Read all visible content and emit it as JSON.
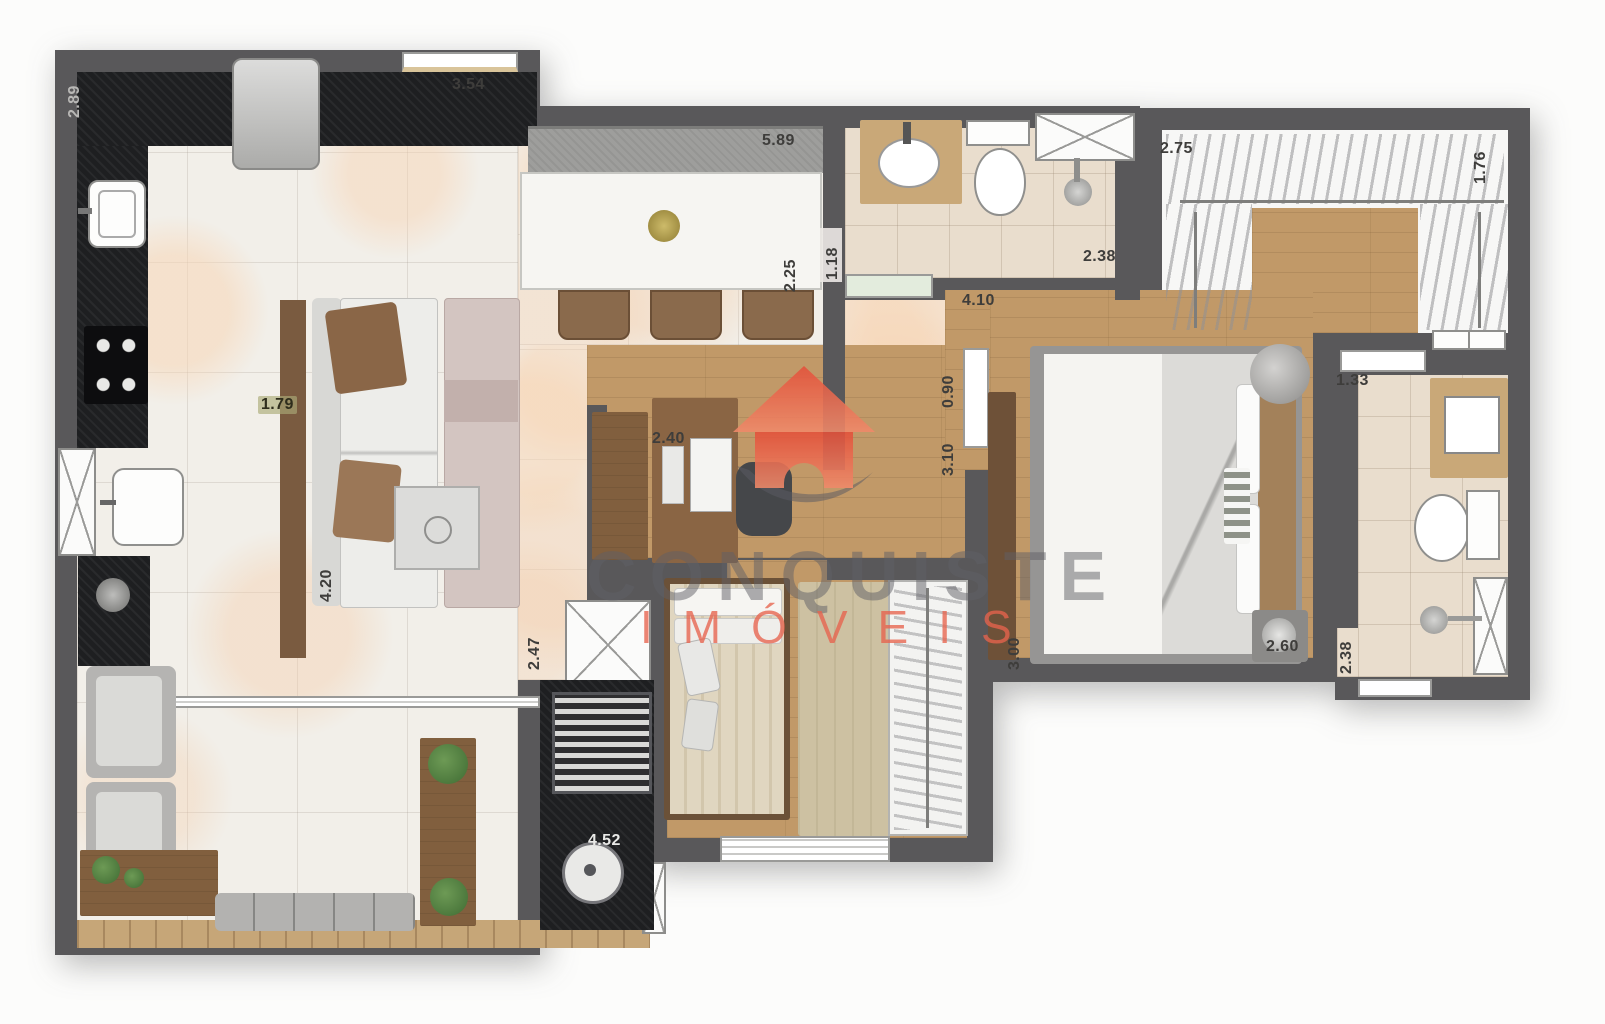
{
  "watermark": {
    "line1": "CONQUISTE",
    "line2": "IMÓVEIS",
    "accent_color": "#E7634D"
  },
  "colors": {
    "wall": "#59585A",
    "marble_floor": "#F2EFE9",
    "wood_floor": "#C19968",
    "bath_tile": "#E9DDCD",
    "counter_black": "#1E1F21",
    "watermark_red": "#E7634D"
  },
  "dimensions": {
    "kitchen_depth": "2.89",
    "kitchen_width": "3.54",
    "living_front": "5.89",
    "dining_depth": "2.25",
    "bath1_entry": "1.18",
    "bath1_width": "2.38",
    "closet_width": "2.75",
    "closet_depth": "1.76",
    "hall_length": "4.10",
    "bedroom_door": "0.90",
    "office_depth": "3.10",
    "kitchen_pass": "1.79",
    "office_width": "2.40",
    "sofa_wall": "4.20",
    "living_depth": "2.47",
    "terrace_width": "4.52",
    "master_width": "3.00",
    "master_foot": "2.60",
    "bath2_depth": "2.38",
    "bath2_door": "1.33"
  }
}
